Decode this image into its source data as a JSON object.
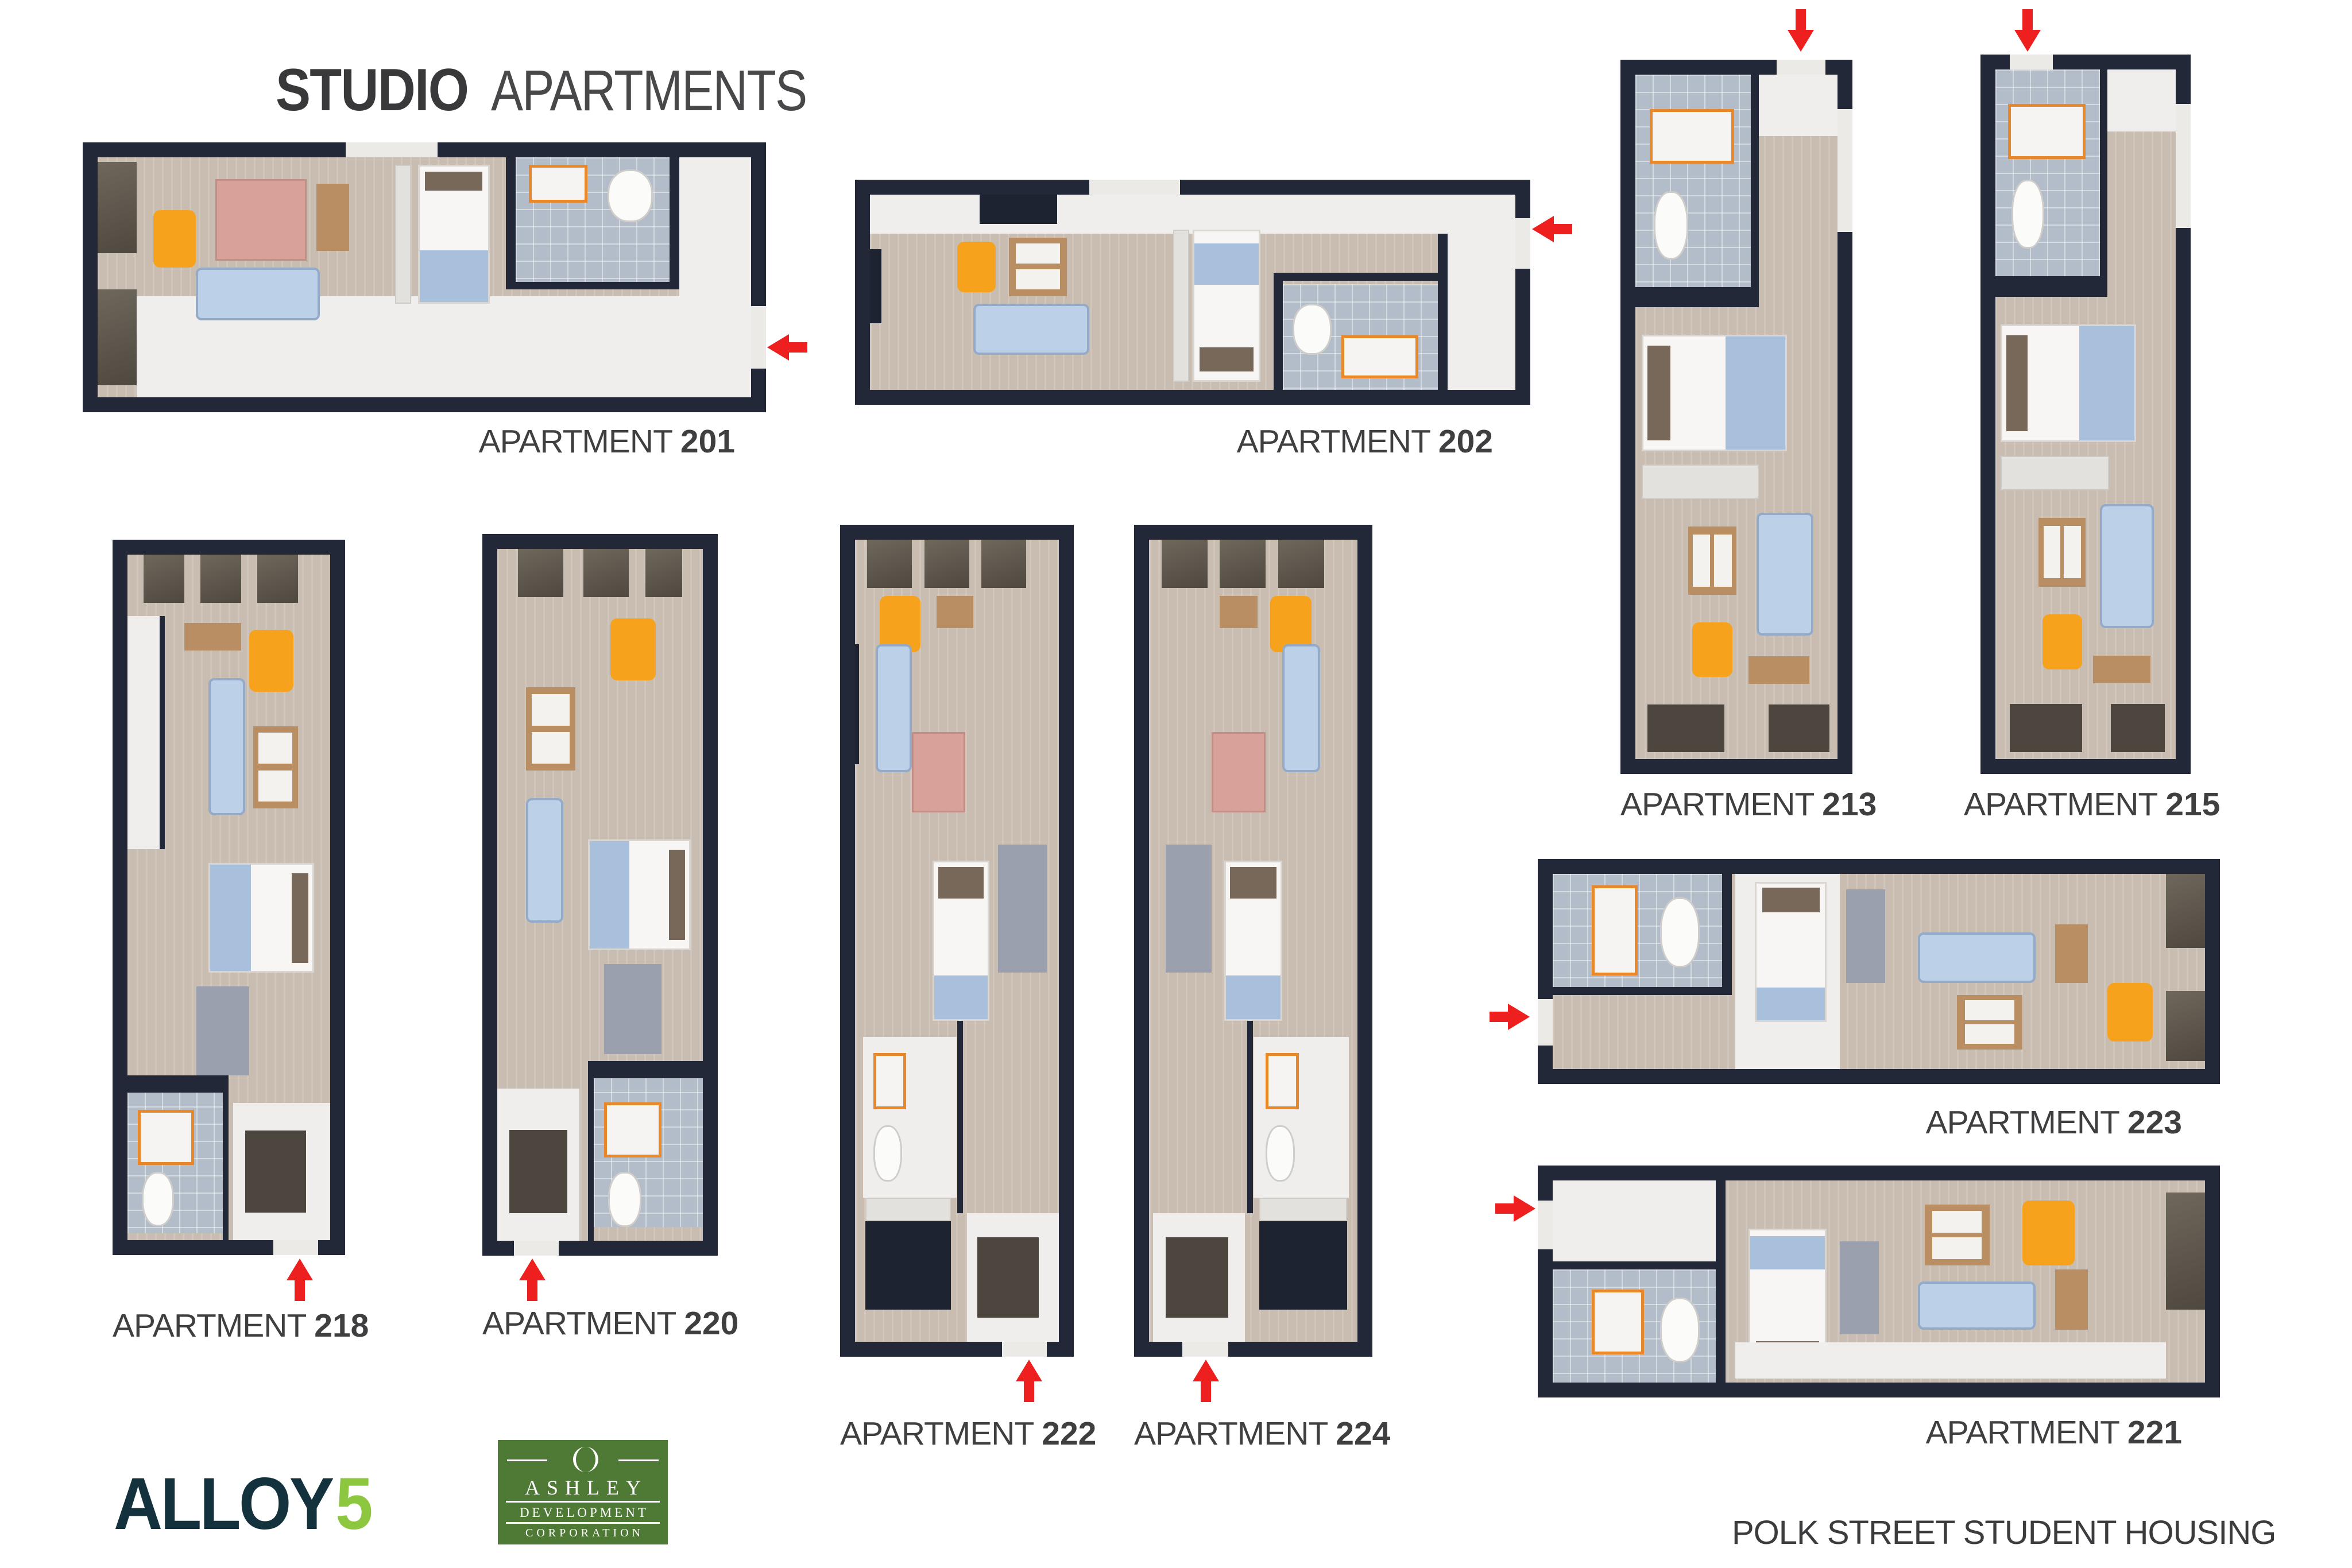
{
  "title": {
    "primary": "STUDIO",
    "secondary": "APARTMENTS"
  },
  "label_prefix": "APARTMENT",
  "apartments": [
    {
      "number": "201",
      "entry_arrow": "left",
      "entry_side": "right"
    },
    {
      "number": "202",
      "entry_arrow": "left",
      "entry_side": "right"
    },
    {
      "number": "213",
      "entry_arrow": "down",
      "entry_side": "top"
    },
    {
      "number": "215",
      "entry_arrow": "down",
      "entry_side": "top"
    },
    {
      "number": "218",
      "entry_arrow": "up",
      "entry_side": "bottom"
    },
    {
      "number": "220",
      "entry_arrow": "up",
      "entry_side": "bottom"
    },
    {
      "number": "222",
      "entry_arrow": "up",
      "entry_side": "bottom"
    },
    {
      "number": "224",
      "entry_arrow": "up",
      "entry_side": "bottom"
    },
    {
      "number": "223",
      "entry_arrow": "right",
      "entry_side": "left"
    },
    {
      "number": "221",
      "entry_arrow": "right",
      "entry_side": "left"
    }
  ],
  "footer": {
    "project_name": "POLK STREET STUDENT HOUSING"
  },
  "logos": {
    "alloy": {
      "name": "ALLOY",
      "number": "5"
    },
    "ashley": {
      "title": "ASHLEY",
      "subtitle": "DEVELOPMENT",
      "subtitle2": "CORPORATION",
      "emblem": "laurel-wreath-icon"
    }
  },
  "colors": {
    "wall": "#232838",
    "carpet": "#c9bdb1",
    "white_floor": "#f0eeec",
    "tile": "#b3bcc9",
    "chair_orange": "#f6a21c",
    "fixture_orange": "#e8882a",
    "sofa_blue": "#bcd0e8",
    "blanket_blue": "#a9c0dc",
    "arrow_red": "#ee1f1f",
    "label_text": "#3f3f41",
    "alloy_navy": "#14323e",
    "alloy_green": "#8dc63f",
    "ashley_green": "#4f7a36"
  }
}
